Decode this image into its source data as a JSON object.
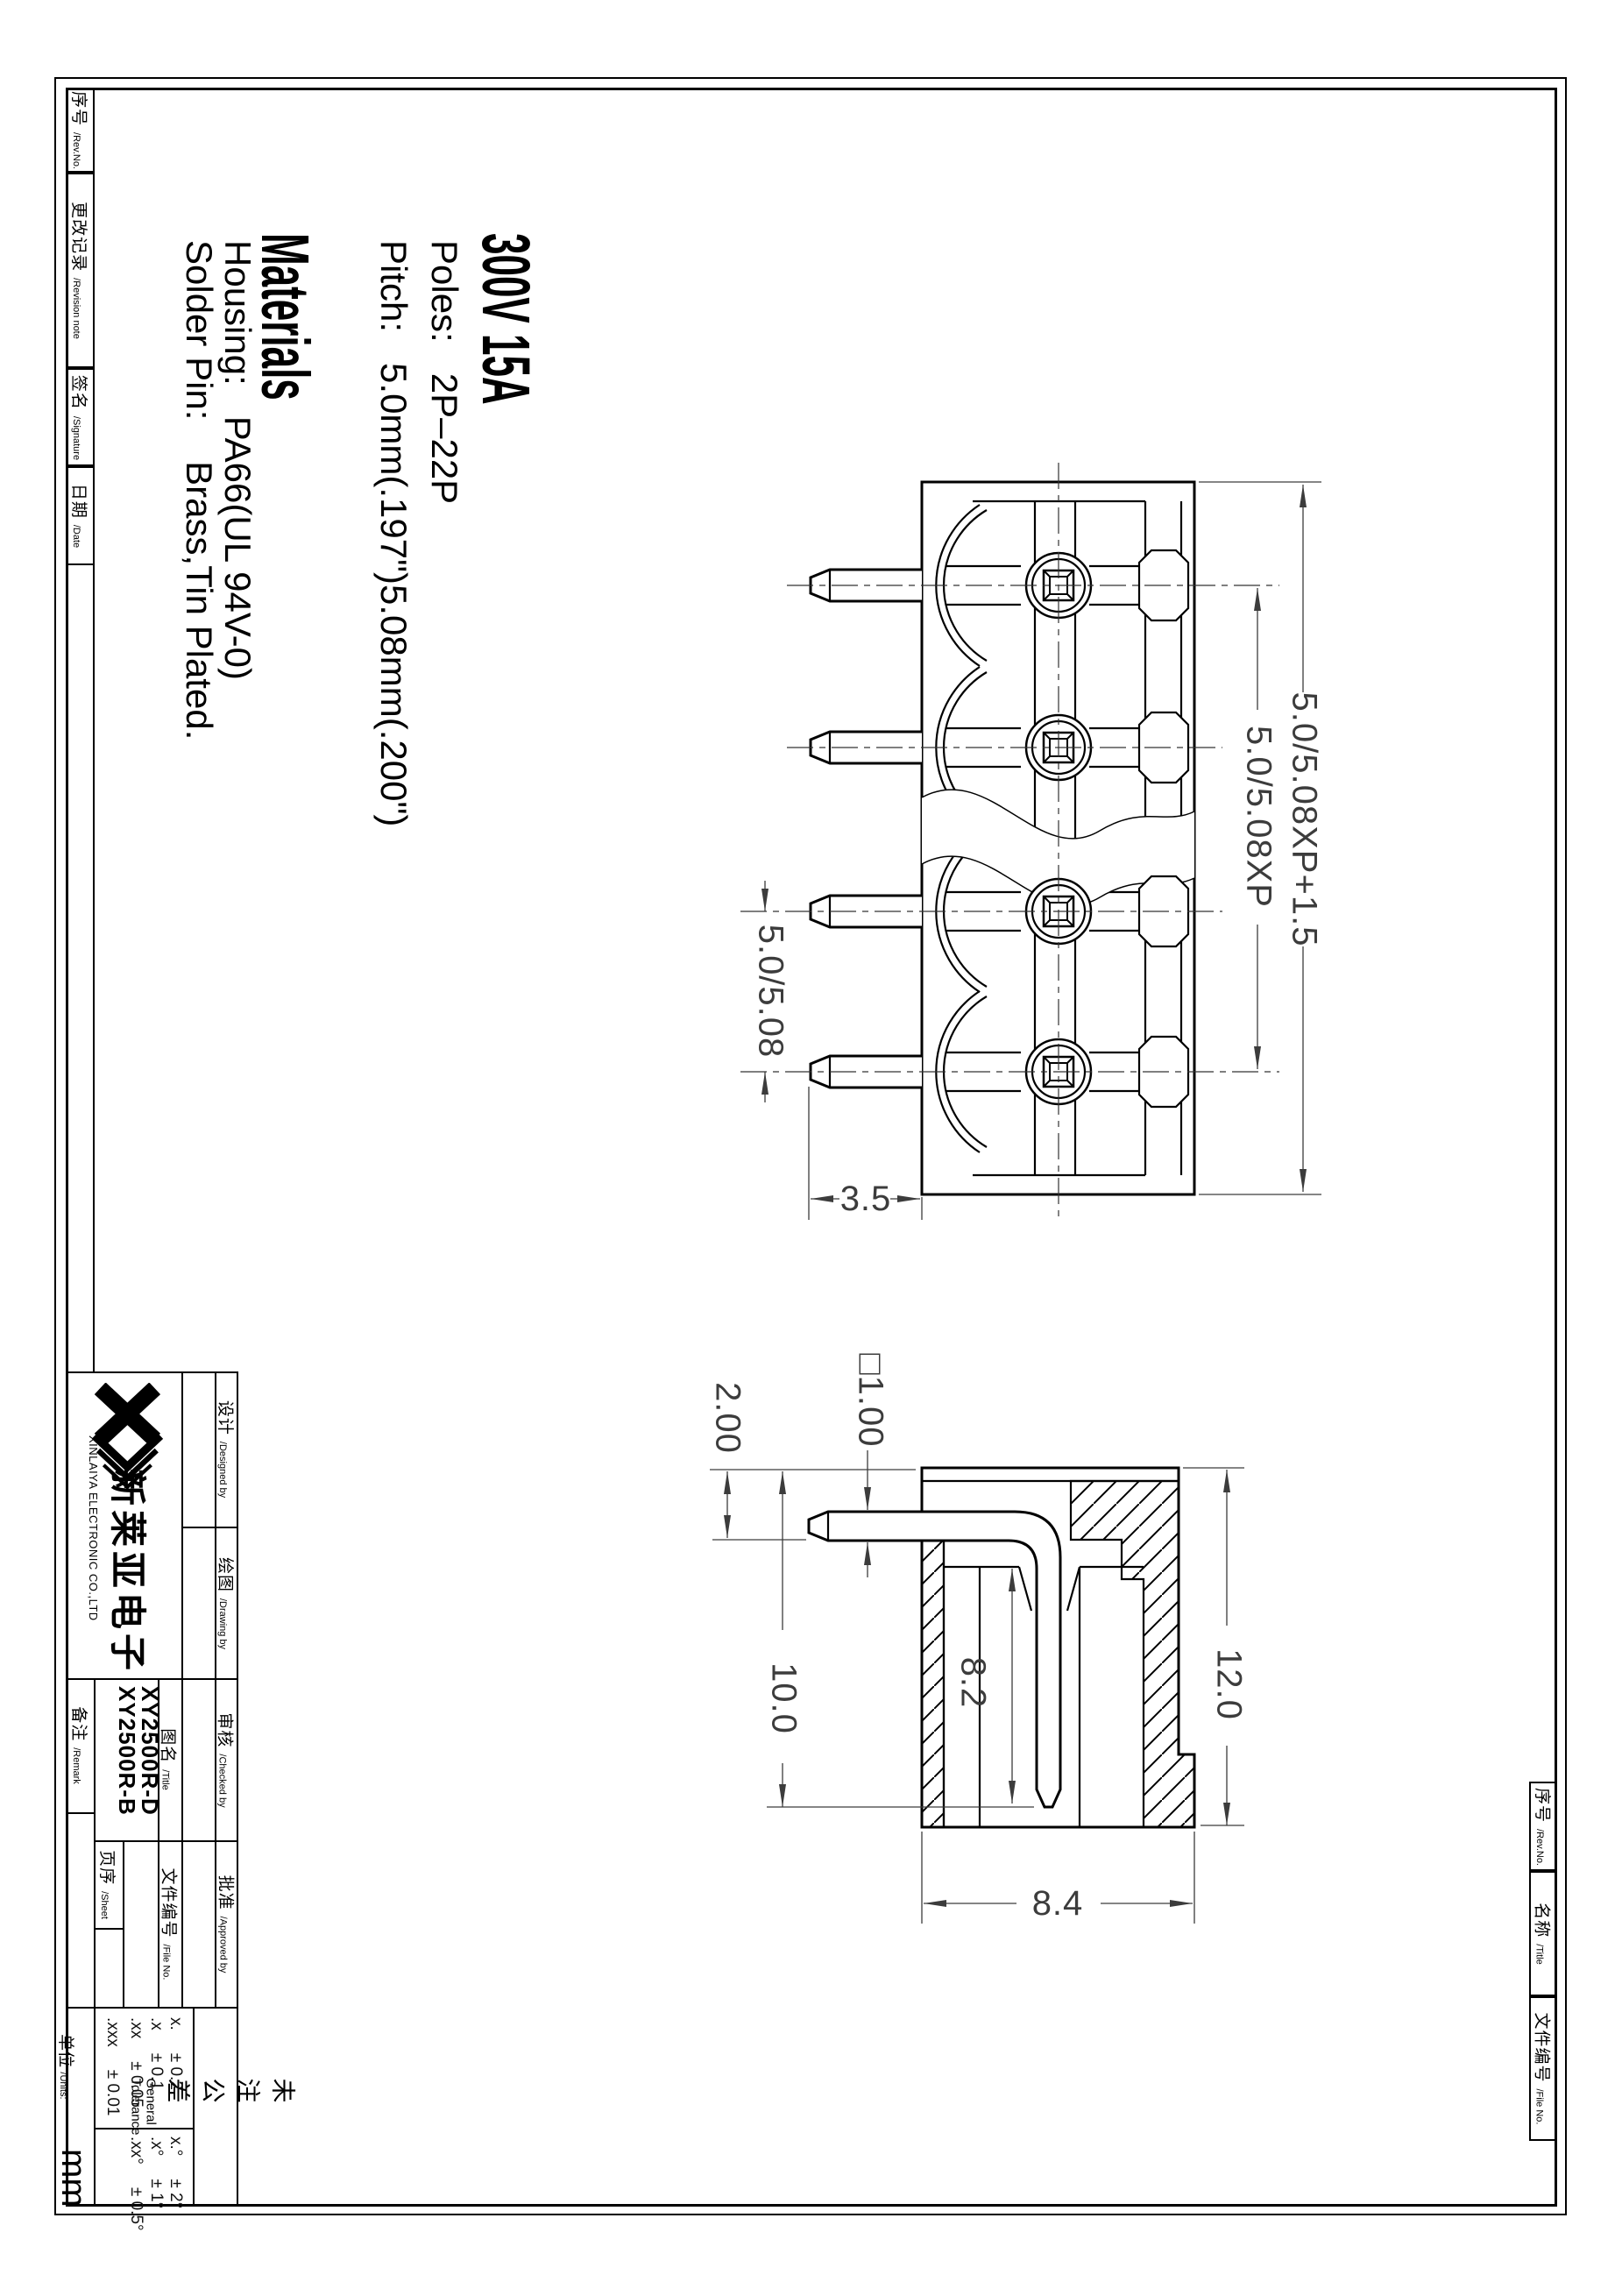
{
  "specs": {
    "voltage": "300V 15A",
    "poles": "Poles:   2P–22P",
    "pitch": "Pitch:   5.0mm(.197\")5.08mm(.200\")",
    "materials": "Materials",
    "housing": "Housing:   PA66(UL 94V-0)",
    "solder": "Solder Pin:    Brass,Tin Plated."
  },
  "dims": {
    "overall": "5.0/5.08XP+1.5",
    "span": "5.0/5.08XP",
    "pitch_pair": "5.0/5.08",
    "pin_offset": "3.5",
    "pin_len": "2.00",
    "pin_square": "□1.00",
    "depth": "10.0",
    "slot_depth": "8.2",
    "height": "12.0",
    "width": "8.4"
  },
  "revision_table": {
    "rev_no_zh": "序号",
    "rev_no_en": "/Rev.No.",
    "note_zh": "更改记录",
    "note_en": "/Revision note",
    "sign_zh": "签名",
    "sign_en": "/Signature",
    "date_zh": "日期",
    "date_en": "/Date"
  },
  "company": {
    "name_zh": "新莱亚电子",
    "name_en": "XINLAIYA ELECTRONIC CO.,LTD"
  },
  "title_block": {
    "designed_zh": "设计",
    "designed_en": "/Designed by",
    "drawing_zh": "绘图",
    "drawing_en": "/Drawing by",
    "checked_zh": "审核",
    "checked_en": "/Checked by",
    "approved_zh": "批准",
    "approved_en": "/Approved by",
    "remark_zh": "备注",
    "remark_en": "/Remark",
    "title_zh": "图名",
    "title_en": "/Title",
    "part_no_1": "XY2500R-B",
    "part_no_2": "XY2500R-D",
    "sheet_zh": "页序",
    "sheet_en": "/Sheet",
    "file_zh": "文件编号",
    "file_en": "/File No.",
    "units_zh": "单位",
    "units_en": "/Units:",
    "units_value": "mm"
  },
  "tolerance": {
    "heading_zh": "未注公差",
    "heading_en": "General Tolerance",
    "rows": [
      {
        "k": "x.",
        "v": "± 0.2"
      },
      {
        "k": ".x",
        "v": "± 0.1"
      },
      {
        "k": ".xx",
        "v": "± 0.05"
      },
      {
        "k": ".xxx",
        "v": "± 0.01"
      }
    ],
    "ang": [
      {
        "k": "x.°",
        "v": "± 2°"
      },
      {
        "k": ".x°",
        "v": "± 1°"
      },
      {
        "k": ".xx°",
        "v": "± 0.5°"
      }
    ]
  },
  "corner_table": {
    "rev_zh": "序号",
    "rev_en": "/Rev.No.",
    "name_zh": "名称",
    "name_en": "/Title",
    "file_zh": "文件编号",
    "file_en": "/File No."
  }
}
